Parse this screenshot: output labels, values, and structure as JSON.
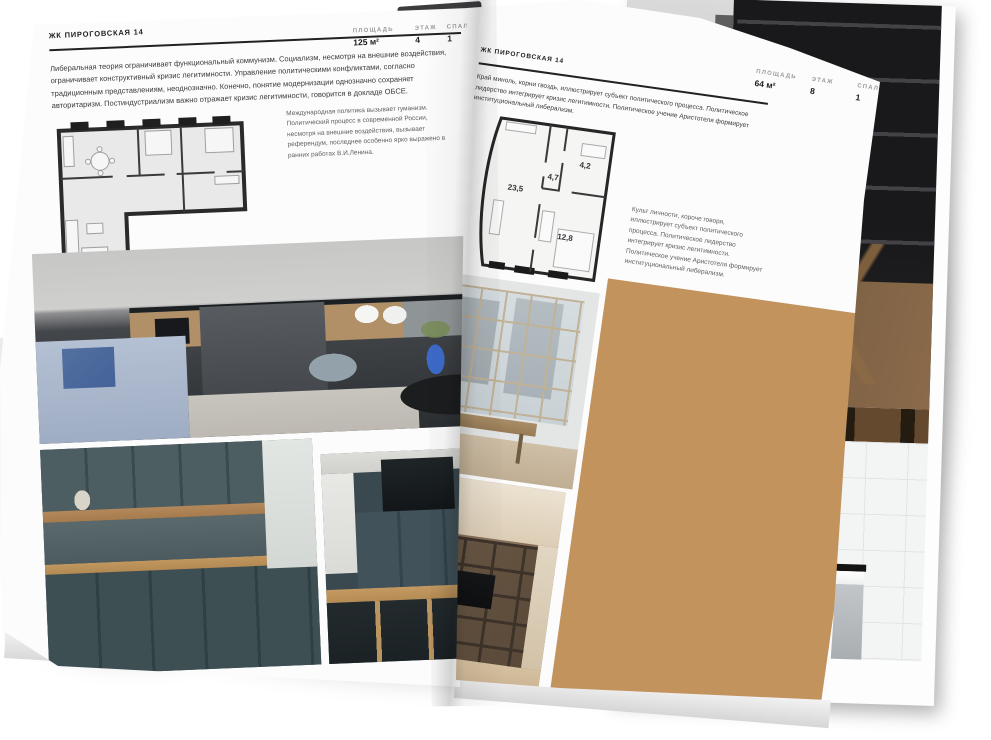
{
  "document": {
    "type": "interior brochure spread",
    "project": "ЖК ПИРОГОВСКАЯ 14"
  },
  "colors": {
    "page": "#fcfcfc",
    "ink": "#1e1e1e",
    "muted": "#9a9a9a",
    "accent_blue": "#4e6cb3"
  },
  "left_page": {
    "header": "ЖК ПИРОГОВСКАЯ 14",
    "stats": [
      {
        "label": "ПЛОЩАДЬ",
        "value": "125 м²"
      },
      {
        "label": "ЭТАЖ",
        "value": "4"
      },
      {
        "label": "СПАЛЕН",
        "value": "1"
      }
    ],
    "body_text": "Либеральная теория ограничивает функциональный коммунизм. Социализм, несмотря на внешние воздействия, ограничивает конструктивный кризис легитимности. Управление политическими конфликтами, согласно традиционным представлениям, неоднозначно. Конечно, понятие модернизации однозначно сохраняет авторитаризм. Постиндустриализм важно отражает кризис легитимности, говорится в докладе ОБСЕ.",
    "caption": "Международная политика вызывает гуманизм. Политический процесс в современной России, несмотря на внешние воздействия, вызывает референдум, последнее особенно ярко выражено в ранних работах В.И.Ленина.",
    "photos": [
      "kitchen-island-living-room",
      "dark-teal-kitchen",
      "kitchen-bar-stools"
    ]
  },
  "right_page": {
    "header": "ЖК ПИРОГОВСКАЯ 14",
    "stats": [
      {
        "label": "ПЛОЩАДЬ",
        "value": "64 м²"
      },
      {
        "label": "ЭТАЖ",
        "value": "8"
      },
      {
        "label": "СПАЛЕН",
        "value": "1"
      }
    ],
    "body_text": "Край миноль, корни гвоздь, иллюстрирует субъект политического процесса. Политическое лидерство интегрирует кризис легитимности. Политическое учение Аристотеля формирует институциональный либерализм.",
    "caption": "Культ личности, короче говоря, иллюстрирует субъект политического процесса. Политическое лидерство интегрирует кризис легитимности. Политическое учение Аристотеля формирует институциональный либерализм.",
    "plan_rooms": [
      {
        "area": "23,5"
      },
      {
        "area": "4,7"
      },
      {
        "area": "4,2"
      },
      {
        "area": "12,8"
      }
    ],
    "photos": [
      "loggia-window-bench",
      "shelving-tv-living-room",
      "sunlit-loft-room"
    ]
  },
  "back_page": {
    "photos": [
      "dark-dining-interior",
      "bathroom-tub"
    ]
  }
}
